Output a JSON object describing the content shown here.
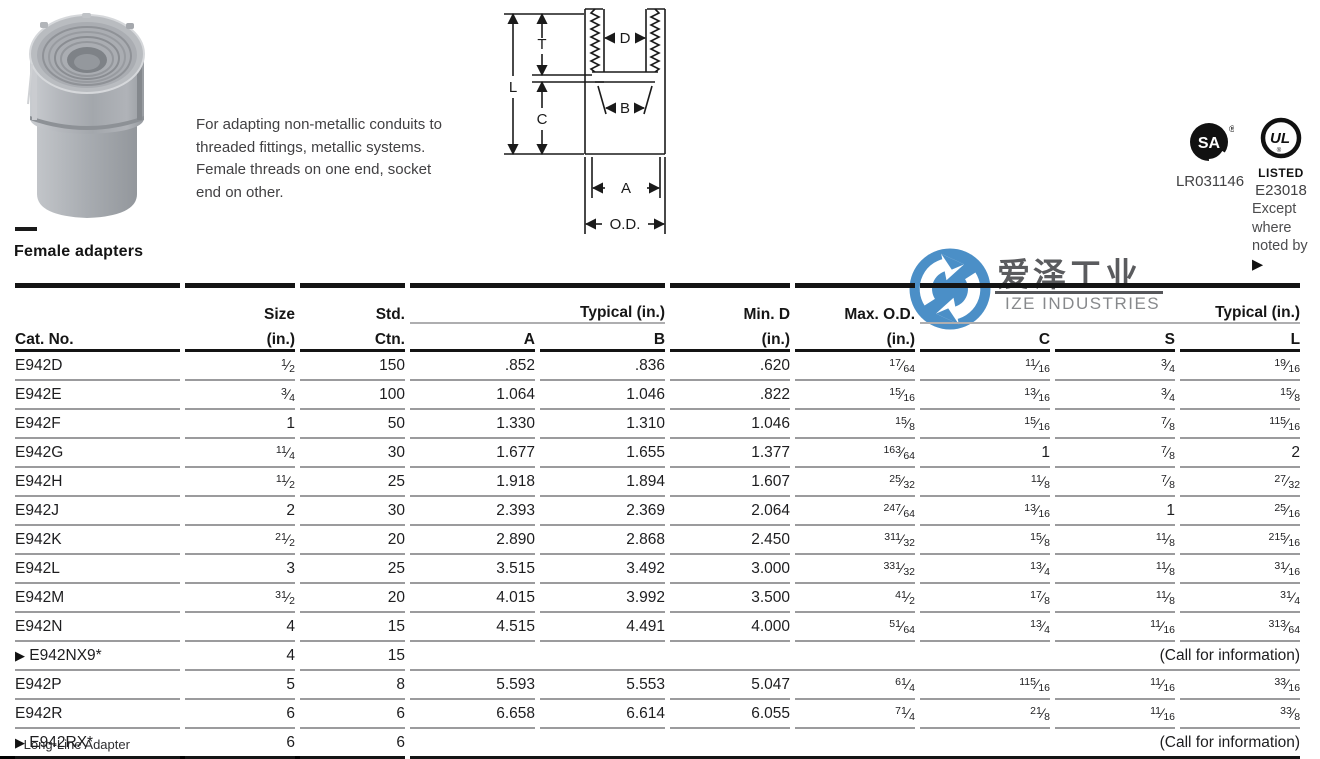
{
  "page": {
    "title": "Female adapters"
  },
  "product": {
    "description": "For adapting non-metallic conduits to threaded fittings, metallic systems. Female threads on one end, socket end on other."
  },
  "diagram": {
    "labels": {
      "t": "T",
      "l": "L",
      "c": "C",
      "d": "D",
      "b": "B",
      "a": "A",
      "od": "O.D."
    }
  },
  "certifications": {
    "csa": {
      "letters": "SA",
      "reg": "®",
      "code": "LR031146"
    },
    "ul": {
      "letters": "UL",
      "reg": "®",
      "listed": "LISTED",
      "code": "E23018"
    },
    "note": "Except where noted by ",
    "note_marker": "▶"
  },
  "watermark": {
    "cn": "爱泽工业",
    "en": "IZE INDUSTRIES",
    "blue": "#4b8fc7"
  },
  "table": {
    "arrow_marker": "▶",
    "headers": {
      "cat": "Cat. No.",
      "size_top": "Size",
      "size_bottom": "(in.)",
      "std_top": "Std.",
      "std_bottom": "Ctn.",
      "typical_left": "Typical (in.)",
      "a": "A",
      "b": "B",
      "min_d_top": "Min. D",
      "min_d_bottom": "(in.)",
      "max_od_top": "Max. O.D.",
      "max_od_bottom": "(in.)",
      "typical_right": "Typical (in.)",
      "c": "C",
      "s": "S",
      "l": "L"
    },
    "rows": [
      {
        "cat": "E942D",
        "arrow": false,
        "size": "1/2",
        "std": "150",
        "a": ".852",
        "b": ".836",
        "min_d": ".620",
        "max_od": "1 7/64",
        "c": "11/16",
        "s": "3/4",
        "l": "1 9/16"
      },
      {
        "cat": "E942E",
        "arrow": false,
        "size": "3/4",
        "std": "100",
        "a": "1.064",
        "b": "1.046",
        "min_d": ".822",
        "max_od": "1 5/16",
        "c": "13/16",
        "s": "3/4",
        "l": "1 5/8"
      },
      {
        "cat": "E942F",
        "arrow": false,
        "size": "1",
        "std": "50",
        "a": "1.330",
        "b": "1.310",
        "min_d": "1.046",
        "max_od": "1 5/8",
        "c": "15/16",
        "s": "7/8",
        "l": "1 15/16"
      },
      {
        "cat": "E942G",
        "arrow": false,
        "size": "1 1/4",
        "std": "30",
        "a": "1.677",
        "b": "1.655",
        "min_d": "1.377",
        "max_od": "1 63/64",
        "c": "1",
        "s": "7/8",
        "l": "2"
      },
      {
        "cat": "E942H",
        "arrow": false,
        "size": "1 1/2",
        "std": "25",
        "a": "1.918",
        "b": "1.894",
        "min_d": "1.607",
        "max_od": "2 5/32",
        "c": "1 1/8",
        "s": "7/8",
        "l": "2 7/32"
      },
      {
        "cat": "E942J",
        "arrow": false,
        "size": "2",
        "std": "30",
        "a": "2.393",
        "b": "2.369",
        "min_d": "2.064",
        "max_od": "2 47/64",
        "c": "1 3/16",
        "s": "1",
        "l": "2 5/16"
      },
      {
        "cat": "E942K",
        "arrow": false,
        "size": "2 1/2",
        "std": "20",
        "a": "2.890",
        "b": "2.868",
        "min_d": "2.450",
        "max_od": "3 11/32",
        "c": "1 5/8",
        "s": "1 1/8",
        "l": "2 15/16"
      },
      {
        "cat": "E942L",
        "arrow": false,
        "size": "3",
        "std": "25",
        "a": "3.515",
        "b": "3.492",
        "min_d": "3.000",
        "max_od": "3 31/32",
        "c": "1 3/4",
        "s": "1 1/8",
        "l": "3 1/16"
      },
      {
        "cat": "E942M",
        "arrow": false,
        "size": "3 1/2",
        "std": "20",
        "a": "4.015",
        "b": "3.992",
        "min_d": "3.500",
        "max_od": "4 1/2",
        "c": "1 7/8",
        "s": "1 1/8",
        "l": "3 1/4"
      },
      {
        "cat": "E942N",
        "arrow": false,
        "size": "4",
        "std": "15",
        "a": "4.515",
        "b": "4.491",
        "min_d": "4.000",
        "max_od": "5 1/64",
        "c": "1 3/4",
        "s": "11/16",
        "l": "3 13/64"
      },
      {
        "cat": "E942NX9*",
        "arrow": true,
        "size": "4",
        "std": "15",
        "call": "(Call for information)"
      },
      {
        "cat": "E942P",
        "arrow": false,
        "size": "5",
        "std": "8",
        "a": "5.593",
        "b": "5.553",
        "min_d": "5.047",
        "max_od": "6 1/4",
        "c": "1 15/16",
        "s": "11/16",
        "l": "3 3/16"
      },
      {
        "cat": "E942R",
        "arrow": false,
        "size": "6",
        "std": "6",
        "a": "6.658",
        "b": "6.614",
        "min_d": "6.055",
        "max_od": "7 1/4",
        "c": "2 1/8",
        "s": "11/16",
        "l": "3 3/8"
      },
      {
        "cat": "E942RX*",
        "arrow": true,
        "size": "6",
        "std": "6",
        "call": "(Call for information)"
      }
    ],
    "footnote": "* Long-Line Adapter"
  }
}
